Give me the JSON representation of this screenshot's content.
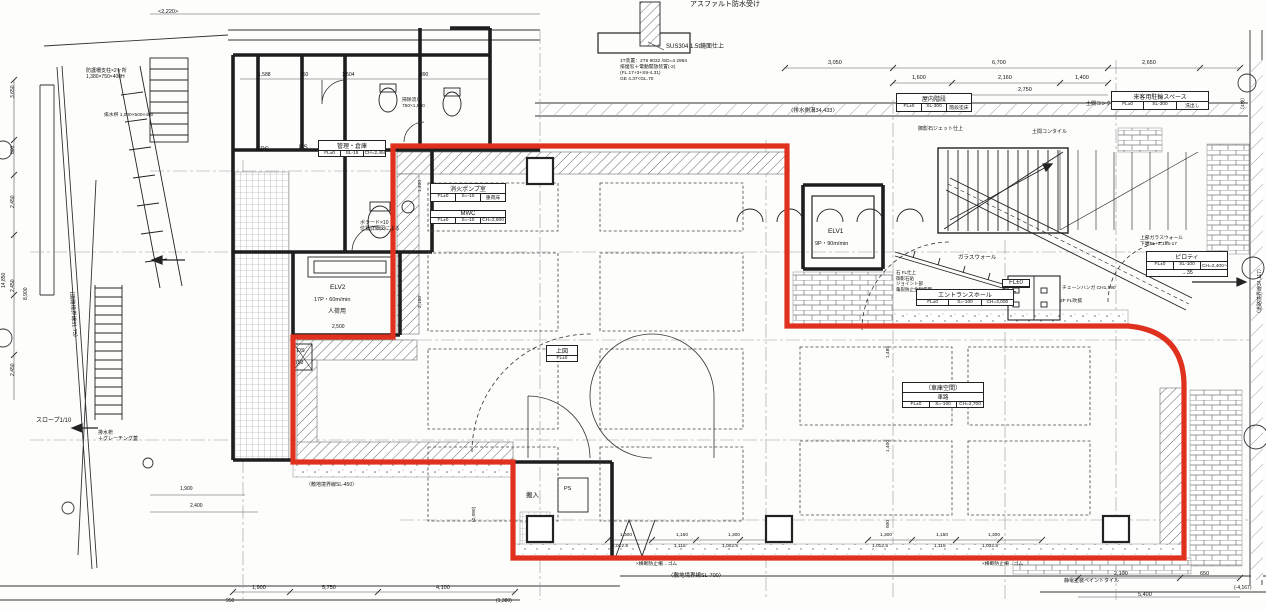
{
  "colors": {
    "boundary_red": "#e0301e",
    "line_black": "#1e1e1e",
    "dim_gray": "#555555"
  },
  "labels": [
    {
      "name": "note-asphalt-waterproof",
      "text": "アスファルト防水受け",
      "x": 690,
      "y": 1,
      "size": 7
    },
    {
      "name": "note-sus304",
      "text": "SUS304 1.5t鏡面仕上",
      "x": 666,
      "y": 44,
      "size": 6
    },
    {
      "name": "note-equipment-spec",
      "text": "1T装置：2T6 9032 /SD=4 2984\n排煙窓＋電動開放装置(-2)\n(FL.17+3+S9-4.31)\nGE 4.37<GL.70",
      "x": 620,
      "y": 59,
      "size": 4.8
    },
    {
      "name": "dim-2220",
      "text": "<2,220>",
      "x": 158,
      "y": 9,
      "size": 5.5
    },
    {
      "name": "dim-1588",
      "text": "1,588",
      "x": 258,
      "y": 72,
      "size": 5
    },
    {
      "name": "dim-750",
      "text": "750",
      "x": 300,
      "y": 72,
      "size": 5
    },
    {
      "name": "dim-1504",
      "text": "1,504",
      "x": 342,
      "y": 72,
      "size": 5
    },
    {
      "name": "dim-990",
      "text": "990",
      "x": 420,
      "y": 72,
      "size": 5
    },
    {
      "name": "dim-3050",
      "text": "3,050",
      "x": 828,
      "y": 60,
      "size": 5.5
    },
    {
      "name": "dim-6700",
      "text": "6,700",
      "x": 992,
      "y": 60,
      "size": 5.5
    },
    {
      "name": "dim-2650",
      "text": "2,650",
      "x": 1142,
      "y": 60,
      "size": 5.5
    },
    {
      "name": "dim-1600",
      "text": "1,600",
      "x": 912,
      "y": 75,
      "size": 5.5
    },
    {
      "name": "dim-2160",
      "text": "2,160",
      "x": 998,
      "y": 75,
      "size": 5.5
    },
    {
      "name": "dim-1400-top",
      "text": "1,400",
      "x": 1075,
      "y": 75,
      "size": 5.5
    },
    {
      "name": "dim-2750",
      "text": "2,750",
      "x": 1018,
      "y": 87,
      "size": 5.5
    },
    {
      "name": "label-drain-ditch",
      "text": "〈排水側溝34,433〉",
      "x": 788,
      "y": 108,
      "size": 5.5
    },
    {
      "name": "note-mikage-stone",
      "text": "御影石ジェット仕上",
      "x": 918,
      "y": 126,
      "size": 5
    },
    {
      "name": "note-doma-tile-1",
      "text": "土間コンクリートタイル",
      "x": 1086,
      "y": 101,
      "size": 5
    },
    {
      "name": "note-doma-tile-2",
      "text": "土間コンタイル",
      "x": 1032,
      "y": 129,
      "size": 5
    },
    {
      "name": "label-eps",
      "text": "EPS",
      "x": 256,
      "y": 146,
      "size": 6.5
    },
    {
      "name": "label-ps-upper",
      "text": "PS",
      "x": 299,
      "y": 144,
      "size": 6.5
    },
    {
      "name": "note-souji-sink",
      "text": "掃除流し\n750×1,500",
      "x": 402,
      "y": 98,
      "size": 4.8
    },
    {
      "name": "label-elv2",
      "text": "ELV2",
      "x": 330,
      "y": 284,
      "size": 6.5
    },
    {
      "name": "label-elv2-spec",
      "text": "17P・60m/min",
      "x": 314,
      "y": 297,
      "size": 5.5
    },
    {
      "name": "label-elv2-use",
      "text": "人荷用",
      "x": 328,
      "y": 309,
      "size": 6
    },
    {
      "name": "dim-2500",
      "text": "2,500",
      "x": 332,
      "y": 324,
      "size": 5
    },
    {
      "name": "label-ds",
      "text": "DS",
      "x": 297,
      "y": 348,
      "size": 5.5
    },
    {
      "name": "dim-750-ds",
      "text": "750",
      "x": 295,
      "y": 360,
      "size": 5
    },
    {
      "name": "note-bollard",
      "text": "ボラード×10\n位置詳細図による",
      "x": 360,
      "y": 220,
      "size": 5
    },
    {
      "name": "note-fence-post",
      "text": "防護柵支柱×2ヶ所\n1,380×750×400H",
      "x": 86,
      "y": 68,
      "size": 5
    },
    {
      "name": "note-drain-basin-size",
      "text": "排水桝 1,000×500×450",
      "x": 104,
      "y": 113,
      "size": 4.8
    },
    {
      "name": "label-slope",
      "text": "スロープ1/10",
      "x": 36,
      "y": 418,
      "size": 6
    },
    {
      "name": "note-grating",
      "text": "排水枡\n＋グレーチング蓋",
      "x": 98,
      "y": 430,
      "size": 5
    },
    {
      "name": "label-road-boundary-left",
      "text": "（道路境界線31.75）",
      "x": 74,
      "y": 288,
      "size": 5.5,
      "rot": 86
    },
    {
      "name": "note-entrance-finish",
      "text": "石 FL仕上\n御影石貼\nジョイント部\n亀裂防止金物使用",
      "x": 896,
      "y": 270,
      "size": 4.5
    },
    {
      "name": "note-chain-hanger",
      "text": "チェーンハンガ CH1,590",
      "x": 1062,
      "y": 286,
      "size": 4.8
    },
    {
      "name": "note-2f-void",
      "text": "2F FL吹抜",
      "x": 1060,
      "y": 299,
      "size": 4.8
    },
    {
      "name": "label-glass-wall",
      "text": "ガラスウォール",
      "x": 958,
      "y": 255,
      "size": 5.5
    },
    {
      "name": "note-upper-glass-wall",
      "text": "上部ガラスウォール\n下端FL+2,165-17",
      "x": 1140,
      "y": 236,
      "size": 4.8
    },
    {
      "name": "label-elv1",
      "text": "ELV1",
      "x": 828,
      "y": 228,
      "size": 6.5
    },
    {
      "name": "label-elv1-spec",
      "text": "9P・90m/min",
      "x": 815,
      "y": 241,
      "size": 5.5
    },
    {
      "name": "label-site-boundary-700",
      "text": "〈敷地境界線SL-700〉",
      "x": 668,
      "y": 573,
      "size": 5.5
    },
    {
      "name": "label-site-boundary-450",
      "text": "〈敷地境界線SL-450〉",
      "x": 306,
      "y": 482,
      "size": 5
    },
    {
      "name": "note-barrier-1",
      "text": "×横断防止柵→ゴム",
      "x": 636,
      "y": 562,
      "size": 4.8
    },
    {
      "name": "note-barrier-2",
      "text": "×横断防止柵→ゴム",
      "x": 982,
      "y": 562,
      "size": 4.8
    },
    {
      "name": "note-paint-tile",
      "text": "静電塗装ペイントタイル",
      "x": 1064,
      "y": 578,
      "size": 5
    },
    {
      "name": "dim-b1-1300a",
      "text": "1,300",
      "x": 620,
      "y": 533,
      "size": 4.8
    },
    {
      "name": "dim-b1-1150",
      "text": "1,150",
      "x": 676,
      "y": 533,
      "size": 4.8
    },
    {
      "name": "dim-b1-1300b",
      "text": "1,300",
      "x": 728,
      "y": 533,
      "size": 4.8
    },
    {
      "name": "dim-b1-10125",
      "text": "1,012.5",
      "x": 612,
      "y": 544,
      "size": 4.8
    },
    {
      "name": "dim-b1-1115",
      "text": "1,115",
      "x": 674,
      "y": 544,
      "size": 4.8
    },
    {
      "name": "dim-b1-10025",
      "text": "1,002.5",
      "x": 722,
      "y": 544,
      "size": 4.8
    },
    {
      "name": "dim-b2-1300a",
      "text": "1,300",
      "x": 880,
      "y": 533,
      "size": 4.8
    },
    {
      "name": "dim-b2-1150",
      "text": "1,150",
      "x": 936,
      "y": 533,
      "size": 4.8
    },
    {
      "name": "dim-b2-1300b",
      "text": "1,300",
      "x": 988,
      "y": 533,
      "size": 4.8
    },
    {
      "name": "dim-b2-10125",
      "text": "1,012.5",
      "x": 872,
      "y": 544,
      "size": 4.8
    },
    {
      "name": "dim-b2-1115",
      "text": "1,115",
      "x": 934,
      "y": 544,
      "size": 4.8
    },
    {
      "name": "dim-b2-10025",
      "text": "1,002.5",
      "x": 982,
      "y": 544,
      "size": 4.8
    },
    {
      "name": "dim-2100",
      "text": "2,100",
      "x": 1114,
      "y": 571,
      "size": 5.5
    },
    {
      "name": "dim-650",
      "text": "650",
      "x": 1200,
      "y": 571,
      "size": 5.5
    },
    {
      "name": "dim-5400",
      "text": "5,400",
      "x": 1138,
      "y": 592,
      "size": 5.5
    },
    {
      "name": "dim-neg4167",
      "text": "(-4,167)",
      "x": 1234,
      "y": 585,
      "size": 5
    },
    {
      "name": "dim-1900-b",
      "text": "1,900",
      "x": 252,
      "y": 585,
      "size": 5.5
    },
    {
      "name": "dim-5750",
      "text": "5,750",
      "x": 322,
      "y": 585,
      "size": 5.5
    },
    {
      "name": "dim-4100",
      "text": "4,100",
      "x": 436,
      "y": 585,
      "size": 5.5
    },
    {
      "name": "dim-950",
      "text": "950",
      "x": 226,
      "y": 598,
      "size": 5
    },
    {
      "name": "dim-1380",
      "text": "(1,380)",
      "x": 496,
      "y": 598,
      "size": 5
    },
    {
      "name": "dim-1900-l",
      "text": "1,900",
      "x": 180,
      "y": 486,
      "size": 5
    },
    {
      "name": "dim-2400-l",
      "text": "2,400",
      "x": 190,
      "y": 503,
      "size": 5
    },
    {
      "name": "dim-3650",
      "text": "3,650",
      "x": 10,
      "y": 98,
      "size": 5,
      "rot": -90
    },
    {
      "name": "dim-800",
      "text": "800",
      "x": 10,
      "y": 154,
      "size": 5,
      "rot": -90
    },
    {
      "name": "dim-2450a",
      "text": "2,450",
      "x": 10,
      "y": 208,
      "size": 5,
      "rot": -90
    },
    {
      "name": "dim-2450b",
      "text": "2,450",
      "x": 10,
      "y": 292,
      "size": 5,
      "rot": -90
    },
    {
      "name": "dim-2450c",
      "text": "2,450",
      "x": 10,
      "y": 376,
      "size": 5,
      "rot": -90
    },
    {
      "name": "dim-14850",
      "text": "14,850",
      "x": 1,
      "y": 288,
      "size": 5,
      "rot": -90
    },
    {
      "name": "dim-8900",
      "text": "8,900",
      "x": 23,
      "y": 300,
      "size": 5,
      "rot": -90
    },
    {
      "name": "dim-1400-int",
      "text": "1,400",
      "x": 418,
      "y": 192,
      "size": 4.8,
      "rot": -90
    },
    {
      "name": "dim-2150-int",
      "text": "2,150",
      "x": 418,
      "y": 308,
      "size": 4.8,
      "rot": -90
    },
    {
      "name": "dim-1485-int",
      "text": "1,485",
      "x": 886,
      "y": 358,
      "size": 4.8,
      "rot": -90
    },
    {
      "name": "dim-1400-int2",
      "text": "1,400",
      "x": 886,
      "y": 452,
      "size": 4.8,
      "rot": -90
    },
    {
      "name": "dim-500-int",
      "text": "500",
      "x": 886,
      "y": 528,
      "size": 4.8,
      "rot": -90
    },
    {
      "name": "dim-2090",
      "text": "(2,090)",
      "x": 472,
      "y": 522,
      "size": 4.8,
      "rot": -90
    },
    {
      "name": "label-road-boundary-right",
      "text": "〈道路境界線34,117〉",
      "x": 1257,
      "y": 316,
      "size": 5,
      "rot": -90
    },
    {
      "name": "dim-4mai",
      "text": "（4枚）",
      "x": 1241,
      "y": 112,
      "size": 4.8,
      "rot": -90
    },
    {
      "name": "label-hannyu",
      "text": "搬入",
      "x": 526,
      "y": 492,
      "size": 6.5
    },
    {
      "name": "label-ps-lower",
      "text": "PS",
      "x": 564,
      "y": 486,
      "size": 5.5
    }
  ],
  "room_tags": [
    {
      "name": "pump-room-tag",
      "x": 430,
      "y": 183,
      "w": 76,
      "title": "消火ポンプ室",
      "cells": [
        "FL±0",
        "S=-10",
        "重荷床"
      ]
    },
    {
      "name": "mwc-tag",
      "x": 430,
      "y": 210,
      "w": 76,
      "title": "MWC",
      "cells": [
        "FL±0",
        "S=-10",
        "CH=2,600"
      ]
    },
    {
      "name": "kanri-souko-tag",
      "x": 318,
      "y": 140,
      "w": 68,
      "title": "管理・倉庫",
      "cells": [
        "FL±0",
        "SL-15",
        "CH=2,450"
      ]
    },
    {
      "name": "indoor-stair-tag",
      "x": 896,
      "y": 93,
      "w": 76,
      "title": "屋内階段",
      "cells": [
        "FL±0",
        "SL-300",
        "階段塗床"
      ]
    },
    {
      "name": "visitor-bicycle-tag",
      "x": 1111,
      "y": 91,
      "w": 98,
      "title": "来客用駐輪スペース",
      "cells": [
        "FL±0",
        "SL-300",
        "洗出し"
      ]
    },
    {
      "name": "entrance-hall-tag",
      "x": 916,
      "y": 289,
      "w": 98,
      "title": "エントランスホール",
      "cells": [
        "FL±0",
        "S=-100",
        "CH=3,000"
      ]
    },
    {
      "name": "piloti-tag",
      "x": 1146,
      "y": 251,
      "w": 82,
      "title": "ピロティ",
      "cells": [
        "FL±0",
        "SL-100",
        "CH=2,400〜"
      ],
      "extra": "→35"
    },
    {
      "name": "garage-space-tag",
      "x": 902,
      "y": 382,
      "w": 82,
      "title": "（車庫空間）",
      "mid": "車路",
      "cells": [
        "FL±0",
        "S=-100",
        "CH=2,700"
      ]
    },
    {
      "name": "jouzu-fl-tag",
      "x": 546,
      "y": 345,
      "w": 32,
      "title": "上図",
      "cells": [
        "FL±0"
      ]
    },
    {
      "name": "fl-zero-tag",
      "x": 1002,
      "y": 279,
      "w": 28,
      "title": "FL±0"
    }
  ]
}
